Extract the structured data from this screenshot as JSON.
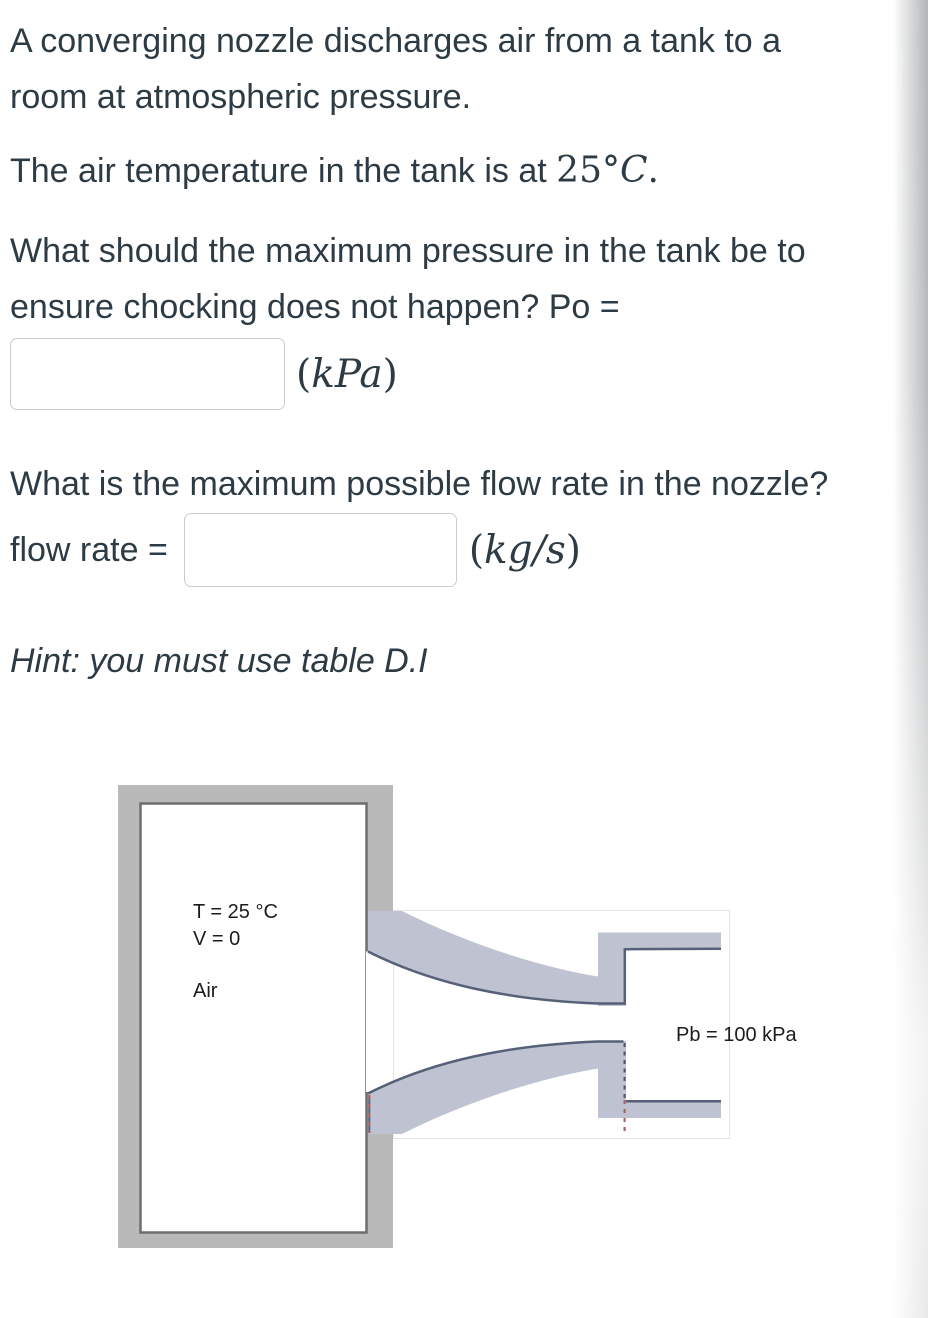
{
  "page": {
    "background": "#ffffff",
    "text_color": "#2d3b45",
    "input_border_color": "#c7cdd1"
  },
  "problem": {
    "p1_line1": "A converging nozzle discharges air from a tank to a",
    "p1_line2": "room at atmospheric pressure.",
    "p2_prefix": "The air temperature in the tank is at ",
    "p2_temp_number": "25°",
    "p2_temp_unit": "C",
    "p2_suffix": ".",
    "p3_line1": "What should the maximum pressure in the tank be to",
    "p3_line2": "ensure chocking does not happen? Po =",
    "po_input_value": "",
    "po_unit_open": "(",
    "po_unit": "kPa",
    "po_unit_close": ")",
    "p4": "What is the maximum possible flow rate in the nozzle?",
    "flow_rate_label": "flow rate =",
    "flow_input_value": "",
    "flow_unit_open": "(",
    "flow_unit": "kg/s",
    "flow_unit_close": ")",
    "hint": "Hint: you must use table D.I"
  },
  "diagram": {
    "tank_label_temp": "T = 25 °C",
    "tank_label_velocity": "V = 0",
    "tank_label_medium": "Air",
    "back_pressure_label": "Pb = 100 kPa",
    "colors": {
      "tank_wall": "#b9b9b9",
      "tank_border": "#6e6e6e",
      "nozzle_fill": "#bfc3d1",
      "nozzle_edge": "#566078",
      "exit_dash_navy": "#4d5878",
      "exit_dash_red": "#b2605f",
      "image_border": "#e4e4e4"
    }
  }
}
